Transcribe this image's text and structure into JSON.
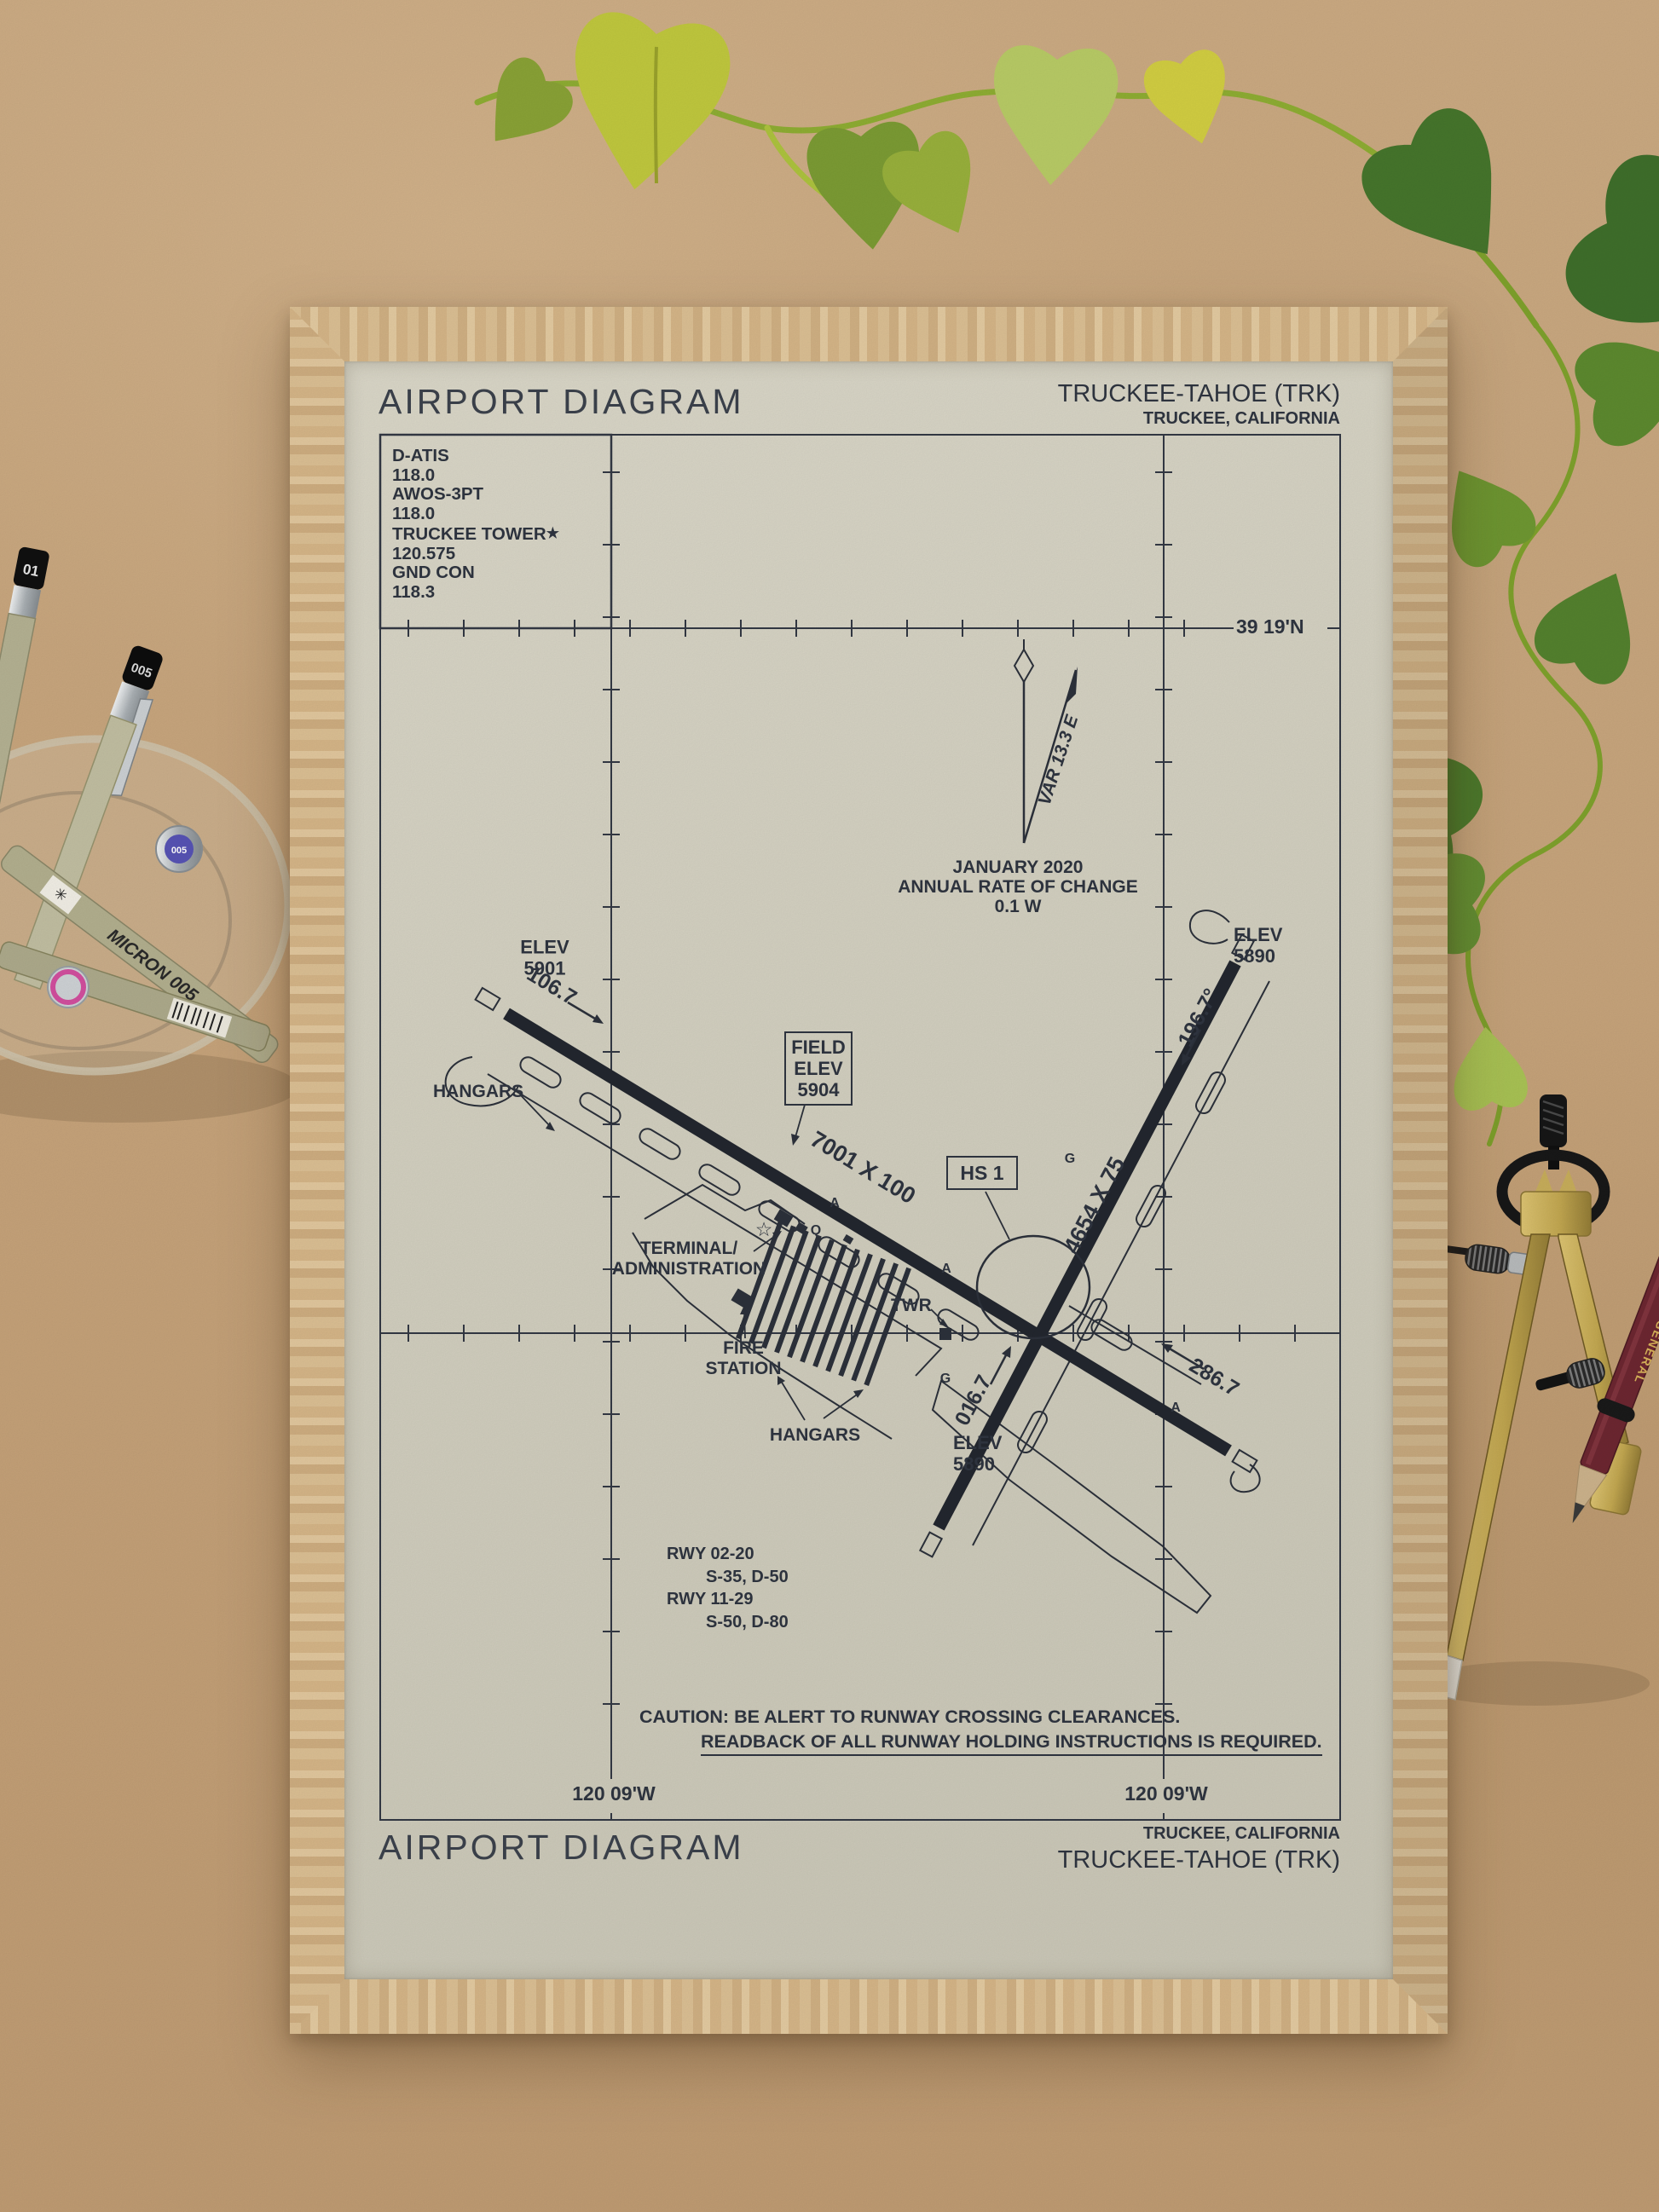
{
  "header": {
    "title": "AIRPORT DIAGRAM",
    "airport": "TRUCKEE-TAHOE (TRK)",
    "city": "TRUCKEE, CALIFORNIA"
  },
  "frequencies": {
    "lines": [
      "D-ATIS",
      "118.0",
      "AWOS-3PT",
      "118.0",
      "TRUCKEE TOWER",
      "120.575",
      "GND CON",
      "118.3"
    ],
    "tower_star": "★"
  },
  "graticule": {
    "lat_top": "39 19'N",
    "lon_left": "120 09'W",
    "lon_right": "120 09'W"
  },
  "magnetic": {
    "var_label": "VAR 13.3 E",
    "date": "JANUARY 2020",
    "rate_line1": "ANNUAL RATE OF CHANGE",
    "rate_line2": "0.1  W"
  },
  "field_elev": {
    "line1": "FIELD",
    "line2": "ELEV",
    "line3": "5904"
  },
  "runways": {
    "rwy_11_29": {
      "dimensions": "7001 X 100",
      "hdg_11": "106.7",
      "hdg_29": "286.7"
    },
    "rwy_02_20": {
      "dimensions": "4654 X 75",
      "hdg_02": "016.7",
      "hdg_20": "196.7°"
    }
  },
  "elevations": {
    "rwy11_end": {
      "label": "ELEV",
      "value": "5901"
    },
    "rwy20_end": {
      "label": "ELEV",
      "value": "5890"
    },
    "rwy02_end": {
      "label": "ELEV",
      "value": "5890"
    }
  },
  "hotspot": {
    "label": "HS 1"
  },
  "facilities": {
    "hangars_west": "HANGARS",
    "terminal_line1": "TERMINAL/",
    "terminal_line2": "ADMINISTRATION",
    "beacon_star": "☆",
    "tower": "TWR",
    "fire_line1": "FIRE",
    "fire_line2": "STATION",
    "hangars_south": "HANGARS"
  },
  "taxiways": {
    "letters": [
      "A",
      "Q",
      "A",
      "G",
      "G",
      "A"
    ]
  },
  "runway_data": {
    "rwy1": "RWY 02-20",
    "rwy1_load": "S-35, D-50",
    "rwy2": "RWY 11-29",
    "rwy2_load": "S-50, D-80"
  },
  "caution": {
    "line1": "CAUTION: BE ALERT TO RUNWAY CROSSING CLEARANCES.",
    "line2": "READBACK OF ALL RUNWAY HOLDING INSTRUCTIONS IS REQUIRED."
  },
  "footer": {
    "title": "AIRPORT DIAGRAM",
    "city": "TRUCKEE, CALIFORNIA",
    "airport": "TRUCKEE-TAHOE (TRK)"
  },
  "stationery": {
    "pen_cap_1": "01",
    "pen_cap_2": "005",
    "pen_cap_3": "005",
    "pen_brand": "MICRON",
    "pencil_brand": "GENERAL"
  },
  "colors": {
    "ink": "#2f3540",
    "paper": "#d3d0c0",
    "board": "#c8a67e",
    "frame_wood": "#d8b88b",
    "plant_green": "#4d7c2d",
    "plant_yellow_green": "#c1c93e",
    "brass": "#c8ae5b",
    "pencil_maroon": "#6d2731",
    "pen_olive": "#b5b293"
  }
}
